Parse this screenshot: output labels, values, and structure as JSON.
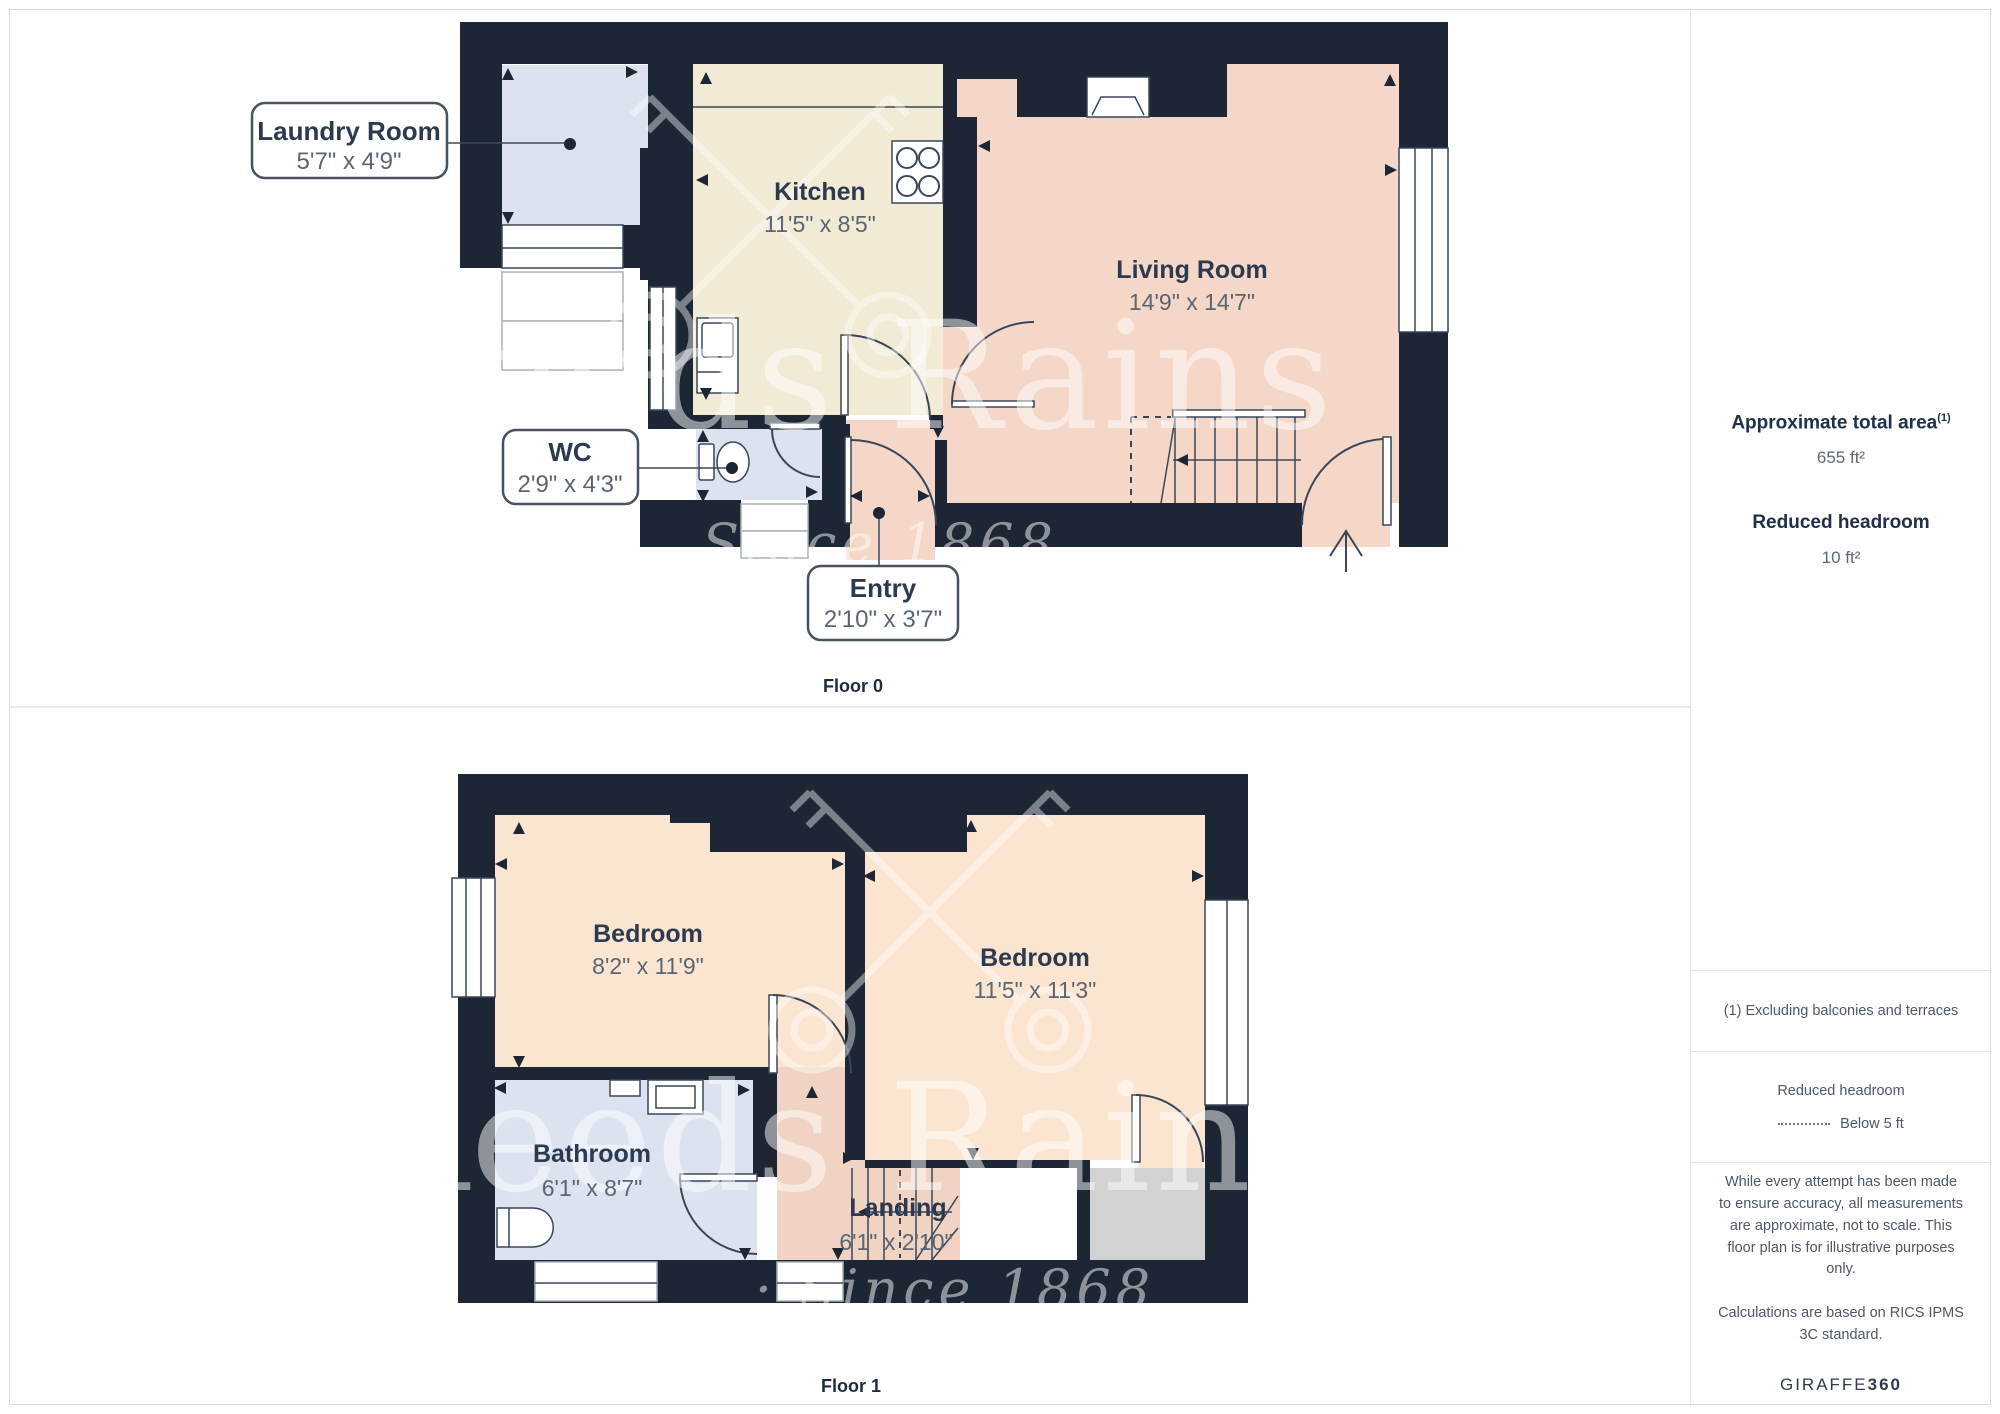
{
  "floor0": {
    "label": "Floor 0",
    "kitchen": {
      "name": "Kitchen",
      "dims": "11'5\" x 8'5\""
    },
    "living": {
      "name": "Living Room",
      "dims": "14'9\" x 14'7\""
    },
    "laundry": {
      "name": "Laundry Room",
      "dims": "5'7\" x 4'9\""
    },
    "wc": {
      "name": "WC",
      "dims": "2'9\" x 4'3\""
    },
    "entry": {
      "name": "Entry",
      "dims": "2'10\" x 3'7\""
    }
  },
  "floor1": {
    "label": "Floor 1",
    "bedroom_left": {
      "name": "Bedroom",
      "dims": "8'2\" x 11'9\""
    },
    "bedroom_right": {
      "name": "Bedroom",
      "dims": "11'5\" x 11'3\""
    },
    "bathroom": {
      "name": "Bathroom",
      "dims": "6'1\" x 8'7\""
    },
    "landing": {
      "name": "Landing",
      "dims": "6'1\" x 2'10\""
    }
  },
  "watermark": {
    "brand": "Reeds Rains",
    "tagline": "Since 1868",
    "tagline_dotted": "· Since 1868"
  },
  "sidebar": {
    "total_area_label": "Approximate total area",
    "total_area_sup": "(1)",
    "total_area_value": "655 ft²",
    "reduced_headroom_label": "Reduced headroom",
    "reduced_headroom_value": "10 ft²",
    "footnote": "(1) Excluding balconies and terraces",
    "legend_title": "Reduced headroom",
    "legend_value": "Below 5 ft",
    "disclaimer1": "While every attempt has been made to ensure accuracy, all measurements are approximate, not to scale. This floor plan is for illustrative purposes only.",
    "disclaimer2": "Calculations are based on RICS IPMS 3C standard.",
    "brand_name": "GIRAFFE",
    "brand_number": "360"
  },
  "colors": {
    "wall": "#1c2634",
    "kitchen": "#f1ead5",
    "living": "#f4d7c7",
    "bedroom": "#fce5d0",
    "landing": "#f0d3c2",
    "wet_room": "#dce2ef",
    "reduced_headroom": "#d2d2d2"
  }
}
